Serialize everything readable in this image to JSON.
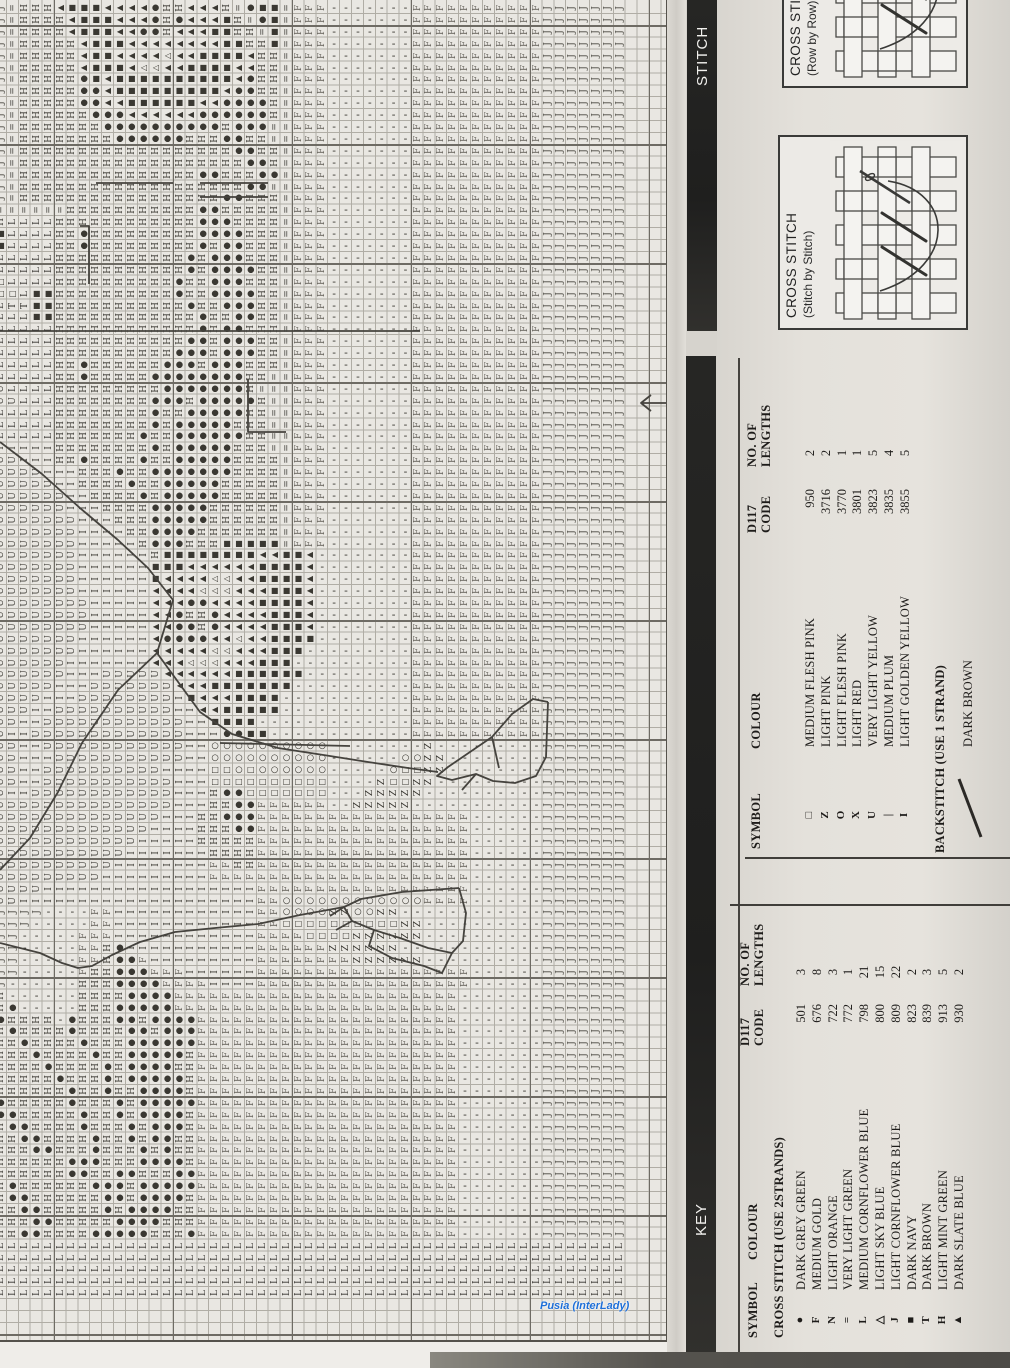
{
  "watermark": "Pusia (InterLady)",
  "bars": {
    "stitching_label": "STITCH",
    "key_label": "KEY"
  },
  "diagrams": {
    "row_by_row": {
      "title": "CROSS STITCH",
      "subtitle": "(Row by Row)"
    },
    "stitch_by_stitch": {
      "title": "CROSS STITCH",
      "subtitle": "(Stitch by Stitch)"
    }
  },
  "key_backstitch_table": {
    "headers": {
      "symbol": "SYMBOL",
      "colour": "COLOUR",
      "code_line1": "D117",
      "code_line2": "CODE",
      "lengths_line1": "NO. OF",
      "lengths_line2": "LENGTHS"
    },
    "rows": [
      {
        "symbol": "□",
        "colour": "MEDIUM FLESH PINK",
        "code": "950",
        "lengths": "2"
      },
      {
        "symbol": "Z",
        "colour": "LIGHT PINK",
        "code": "3716",
        "lengths": "2"
      },
      {
        "symbol": "O",
        "colour": "LIGHT FLESH PINK",
        "code": "3770",
        "lengths": "1"
      },
      {
        "symbol": "X",
        "colour": "LIGHT RED",
        "code": "3801",
        "lengths": "1"
      },
      {
        "symbol": "U",
        "colour": "VERY LIGHT YELLOW",
        "code": "3823",
        "lengths": "5"
      },
      {
        "symbol": "|",
        "colour": "MEDIUM PLUM",
        "code": "3835",
        "lengths": "4"
      },
      {
        "symbol": "I",
        "colour": "LIGHT GOLDEN YELLOW",
        "code": "3855",
        "lengths": "5"
      }
    ],
    "backstitch_title": "BACKSTITCH (USE 1 STRAND)",
    "backstitch_rows": [
      {
        "symbol": "diagonal-line",
        "colour": "DARK BROWN"
      }
    ]
  },
  "key_cross_stitch_table": {
    "headers": {
      "symbol": "SYMBOL",
      "colour": "COLOUR",
      "code_line1": "D117",
      "code_line2": "CODE",
      "lengths_line1": "NO. OF",
      "lengths_line2": "LENGTHS"
    },
    "section_title": "CROSS STITCH (USE 2STRANDS)",
    "rows": [
      {
        "symbol": "●",
        "colour": "DARK GREY GREEN",
        "code": "501",
        "lengths": "3"
      },
      {
        "symbol": "F",
        "colour": "MEDIUM GOLD",
        "code": "676",
        "lengths": "8"
      },
      {
        "symbol": "N",
        "colour": "LIGHT ORANGE",
        "code": "722",
        "lengths": "3"
      },
      {
        "symbol": "=",
        "colour": "VERY LIGHT GREEN",
        "code": "772",
        "lengths": "1"
      },
      {
        "symbol": "L",
        "colour": "MEDIUM CORNFLOWER BLUE",
        "code": "798",
        "lengths": "21"
      },
      {
        "symbol": "△",
        "colour": "LIGHT SKY BLUE",
        "code": "800",
        "lengths": "15"
      },
      {
        "symbol": "J",
        "colour": "LIGHT CORNFLOWER BLUE",
        "code": "809",
        "lengths": "22"
      },
      {
        "symbol": "■",
        "colour": "DARK NAVY",
        "code": "823",
        "lengths": "2"
      },
      {
        "symbol": "T",
        "colour": "DARK BROWN",
        "code": "839",
        "lengths": "3"
      },
      {
        "symbol": "H",
        "colour": "LIGHT MINT GREEN",
        "code": "913",
        "lengths": "5"
      },
      {
        "symbol": "▲",
        "colour": "DARK SLATE BLUE",
        "code": "930",
        "lengths": "2"
      }
    ]
  },
  "chart": {
    "columns": 56,
    "rows": 113,
    "cell_px": 11.9,
    "origin_x": -5,
    "origin_y": 2,
    "palette": {
      "I": {
        "g": "H",
        "r": 1,
        "c": "#37352f",
        "fs": 9
      },
      "H": {
        "g": "I",
        "r": 1,
        "c": "#37352f",
        "fs": 9
      },
      "C": {
        "g": "U",
        "r": 1,
        "c": "#45433d",
        "fs": 9
      },
      "F": {
        "g": "F",
        "r": 1,
        "c": "#615e57",
        "fs": 9
      },
      "J": {
        "g": "J",
        "r": 1,
        "c": "#4a4841",
        "fs": 9
      },
      "L": {
        "g": "L",
        "r": 1,
        "c": "#33312c",
        "fs": 9
      },
      "T": {
        "g": "T",
        "r": 1,
        "c": "#33312c",
        "fs": 9
      },
      "Z": {
        "g": "Z",
        "r": 1,
        "c": "#37352f",
        "fs": 9
      },
      "=": {
        "g": "=",
        "r": 1,
        "c": "#45433d",
        "fs": 9
      },
      "-": {
        "g": "-",
        "r": 0,
        "c": "#37352f",
        "fs": 11
      },
      "o": {
        "g": "●",
        "r": 0,
        "c": "#3a3832",
        "fs": 8.5
      },
      "O": {
        "g": "○",
        "r": 0,
        "c": "#37352f",
        "fs": 8.5
      },
      "s": {
        "g": "■",
        "r": 0,
        "c": "#3a3832",
        "fs": 8
      },
      "q": {
        "g": "□",
        "r": 0,
        "c": "#37352f",
        "fs": 8
      },
      "a": {
        "g": "▲",
        "r": 1,
        "c": "#3a3832",
        "fs": 8
      },
      "d": {
        "g": "△",
        "r": 1,
        "c": "#37352f",
        "fs": 8
      },
      "X": {
        "g": "X",
        "r": 0,
        "c": "#37352f",
        "fs": 9
      }
    },
    "grid_rows": [
      "J=IIIasssaaaaoIIaaaI=oss=FFF-------FFFFFFFFFFFJJJJJJJ...",
      "J=IIIIasssaaaoIoaaasI=os=FFF-------FFFFFFFFFFFJJJJJJJ...",
      "J=IIIIasssaaooIaaassII=s=FFF-------FFFFFFFFFFFJJJJJJJ...",
      "J=IIIIIasssaaaaaaaassIIs=FFF-------FFFFFFFFFFFJJJJJJJ...",
      "J=IIIIIassaaaadaassssaII=FFF-------FFFFFFFFFFFJJJJJJJ...",
      "J=IIIIIasssaddaassssaaII=FFF-------FFFFFFFFFFFJJJJJJJ...",
      "J=IIIIIosassssssssssaoII=FFF-------FFFFFFFFFFFJJJJJJJ...",
      "J=IIIIIooasssssssssaooII=FFF-------FFFFFFFFFFFJJJJJJJ...",
      "J=IIIIIooaassssssaaooooI=FFF-------FFFFFFFFFFFJJJJJJJ...",
      "J=IIIIIIoooaaaaaaooooooI=FFF-------FFFFFFFFFFFJJJJJJJ...",
      "J=IIIIIIIooooooooooIooo==FFF-------FFFFFFFFFFFJJJJJJJ...",
      "J=IIIIIIIIooooooIIIooII==FFF-------FFFFFFFFFFFJJJJJJJ...",
      "J=IIIIIIIIIIIIIIIIIIooII=FFF-------FFFFFFFFFFFJJJJJJJ...",
      "J=IIIIIIIIIIIIIIIIIIIooI=FFF-------FFFFFFFFFFFJJJJJJJ...",
      "J=IIIIIIIIIIIIIIIooIIIoo=FFF-------FFFFFFFFFFFJJJJJJJ...",
      "J=IIIIIIIIIIIIIIIIIIIoo==FFF-------FFFFFFFFFFFJJJJJJJ...",
      "J=IIIIIIIIIIIIIIIIIooIII=FFF-------FFFFFFFFFFFJJJJJJJ...",
      "======IIIIIIIIIIIooIIIII=FFF-------FFFFFFFFFFFJJJJJJJ...",
      "ILLLLIIIIIIIIIIIIoooIIII=FFF-------FFFFFFFFFFFJJJJJJJ...",
      "sLLLLIIoIIIIIIIIIooooIII=FFF-------FFFFFFFFFFFJJJJJJJ...",
      "sLLLLIIoIIIIIIIIIoIooIII=FFF-------FFFFFFFFFFFJJJJJJJ...",
      "LLLLLIIIIIIIIIIIoIoooIII=FFF-------FFFFFFFFFFFJJJJJJJ...",
      "LLLLLIIIIIIIIIIIoIooooII=FFF-------FFFFFFFFFFFJJJJJJJ...",
      "qLLLLIIIIIIIIIIoIIoooIII=FFF-------FFFFFFFFFFFJJJJJJJ...",
      "qqLssIIIIIIIIIIoIIooooII=FFF-------FFFFFFFFFFFJJJJJJJ...",
      "LTTssIIIIIIIIIIIoIIoooII=FFF-------FFFFFFFFFFFJJJJJJJ...",
      "LLLssIIIIIIIIIIIIoIIooII=FFF-------FFFFFFFFFFFJJJJJJJ...",
      "LLLLLIIIIIIIIIIIIoIooIII=FFF-------FFFFFFFFFFFJJJJJJJ...",
      "LLLLLIIIIIIIIIIIooIoooII=FFF-------FFFFFFFFFFFJJJJJJJ...",
      "LLLLLIIIIIIIIIIoooIoooII=FFF-------FFFFFFFFFFFJJJJJJJ...",
      "LLLLLIIoIIIIIIoooIoooIII=FFF-------FFFFFFFFFFFJJJJJJJ...",
      "LLLLLIIoIIIIIooooooooII==FFF-------FFFFFFFFFFFJJJJJJJ...",
      "CLLLLIIIIIIIIIoooooooI===FFF-------FFFFFFFFFFFJJJJJJJ...",
      "CCLLLIIIIIIIIoooIoooooI==FFF-------FFFFFFFFFFFJJJJJJJ...",
      "LLLLLIIIIIIIIoIIoooooII==FFF-------FFFFFFFFFFFJJJJJJJ...",
      "LLLLLIIIIIIIIoIoooooIII==FFF-------FFFFFFFFFFFJJJJJJJ...",
      "LLLLLIIIIIIIoIIooooooII==FFF-------FFFFFFFFFFFJJJJJJJ...",
      "HHHHHIIIIIIIIoIoooooIII==FFF-------FFFFFFFFFFFJJJJJJJ...",
      "CCHHHIIoIIIIoIIoooooIIII=FFF-------FFFFFFFFFFFJJJJJJJ...",
      "CCCCHHHIIIoIIoooooooIIII=FFF-------FFFFFFFFFFFJJJJJJJ...",
      "CCCCCHHIIIIoIIoooooIIIII=FFF-------FFFFFFFFFFFJJJJJJJ...",
      "CCCCCCHHIIIIoIoooooIIIII=FFF-------FFFFFFFFFFFJJJJJJJ...",
      "CCCCCCHHHIIIIoooooIIIIII=FFF-------FFFFFFFFFFFJJJJJJJ...",
      "CCCCCCCHHHIIIoooooIIIIII=FFF-------FFFFFFFFFFFJJJJJJJ...",
      "CCCCCCCHHHHIIooooIIIIIII=FFF-------FFFFFFFFFFFJJJJJJJ...",
      "CCCCCCCHHHHHIoooIIIsssss=FFF-------FFFFFFFFFFFJJJJJJJ...",
      "CCCCCCCHHHHHHIssssssssaassa--------FFFFFFFFFFFJJJJJJJ...",
      "CCCCCCCHHHHHHsssaaaaaassssa--------FFFFFFFFFFFJJJJJJJ...",
      "CCCCCCCHHHHHHsaaaaddaassssa--------FFFFFFFFFFFJJJJJJJ...",
      "CCCCCCCHHHHHHaaaadddaaasssa--------FFFFFFFFFFFJJJJJJJ...",
      "CCCCCCCCHHHHHaaaooaaaassssa--------FFFFFFFFFFFJJJJJJJ...",
      "CCCCCCCCHHHHHaaoIIoaaaasssa--------FFFFFFFFFFFJJJJJJJ...",
      "CCCCCCCCHHHHHaaooIoaaaasssa--------FFFFFFFFFFFJJJJJJJ...",
      "CCCCCCCHHHHHHaooooaadaassss--------FFFFFFFFFFFJJJJJJJ...",
      "CCCCCCCHHHHHHaaaaaddaaasss---------FFFFFFFFFFFJJJJJJJ...",
      "CCCCCCHHHHHHHaaadddaaasss----------FFFFFFFFFFFJJJJJJJ...",
      "CCCCCCHHHCCCCCaaaaaassssss---------FFFFFFFFFFFJJJJJJJ...",
      "CCCCCHHHCCCCCCCaaasssssss----------FFFFFFFFFFFJJJJJJJ...",
      "CCCCHHHCCCCCCCCHsaaassss-----------FFFFFFFFFFFJJJJJJJ...",
      "CCCHHCCCCCCCCCCHHaasssss-----------FFFFFFFFFFFJJJJJJJ...",
      "CCHHCCCCCCCCCCCCHHssss-------------FFFFFFFFFFFJJJJJJJ...",
      "CHHCCCCCCCCCCCCCHHHooss------------FFFFFFFFFFFJJJJJJJ...",
      "CCHHCCCCCCCCCCCCHHOOOOOOOOOO--------Z---------JJJJJJJ...",
      "CCHHHCCCCCCCCCCCHHOOOOOOOOOO------OOZZ--------JJJJJJJ...",
      "CCHHCCCCCCCCCCHHHHqqOqOOOOOO-----OqqZZ--------JJJJJJJ...",
      "CCHHCCCCCCCCCCCHHHqqqqqqqqqq----ZqqZZ---------JJJJJJJ...",
      "CHHCCCCCCCCCCCCHHHIooqqqqqqq---ZZZZZ----------JJJJJJJ...",
      "CCCCCCCCCCCCCCCHHHIIooFFFFFF--ZZZZZ-----------JJJJJJJ...",
      "CCCCCCCCCCCCCCHHHIIoooFFFFFFFFFFFFFFFFFF------JJJJJJJ...",
      "CCCCCCCCCCCCCHHHHIIIooFFFFFFFFFFFFFFFFFF------JJJJJJJ...",
      "CCCCCCCCCCCCHHHHHIIIIIFFFFFFFFFFFFFFFFFF------JJJJJJJ...",
      "CCCCCCCCCCCHHHHHHHIIIIFFFFFFFFFFFFFFFFFF------JJJJJJJ...",
      "CCCCCCCCCCHHHHHHHHFFIIFFFFFFFFFFFFFFFFFF------JJJJJJJ...",
      "CCCCCCCCCHHHHHHHHHFFFFFFFFFFFFFFFFFFFFFF------JJJJJJJ...",
      "CCCCHHHHHHHHHHHHHHHHHHFFFFFFFFFFFFFFFFFF------JJJJJJJ...",
      "CCHHHHHHHHHHHHHHHHHHHHFFOOOOOOOOOOOOFFFF------JJJJJJJ...",
      "JJJJ----FFHHHHHHHHHHHHFFOOOOZZOOZZ------------JJJJJJJ...",
      "JJJ-----FFHHHHHHHHHHHHFFqqqqqqqqqqZZ----------JJJJJJJ...",
      "JJ-----FFFHHHHHHHHHHHHFFFFqqqqZZZZZZ----------JJJJJJJ...",
      "JJ-----FFIoHHHHHHHHHHHFFFFFFZZZZZZ------------JJJJJJJ...",
      "JJ-----FFIooFHHHHHHHHHFFFFFFFFZZZZZZ----------JJJJJJJ...",
      "JJ-----FIIoooFFFHHHHHHFFFFFFFFFFFFFFFFFF------JJJJJJJ...",
      "J------IIIooooFFFFHHHHFFFFFFFFFFFFFFFFFF------JJJJJJJ...",
      "I------IIIIooooFFFFFFFFFFFFFFFFFFFFFFFF-------JJJJJJJ...",
      "Io-----IIIoooooFFFFFFFFFFFFFFFFFFFFFFFF-------JJJJJJJ...",
      "oIIII-oIIIooIooooFFFFFFFFFFFFFFFFFFFFFF-------JJJJJJJ...",
      "IoIIIIoIIIIooIoooFFFFFFFFFFFFFFFFFFFFFF-------JJJJJJJ...",
      "IIoIIIIoIIIooooooFFFFFFFFFFFFFFFFFFFFFF-------JJJJJJJ...",
      "IIIoIIIIoIIoooooIFFFFFFFFFFFFFFFFFFFFFF-------JJJJJJJ...",
      "IIIIoIIIIoIooooIIFFFFFFFFFFFFFFFFFFFFFF-------JJJJJJJ...",
      "IIIIIoIIIoIoooooIFFFFFFFFFFFFFFFFFFFFFF-------JJJJJJJ...",
      "IIIIIIoIIoIIooooIFFFFFFFFFFFFFFFFFFFFFF-------JJJJJJJ...",
      "oIIIIIoIIIoIoooooFFFFFFFFFFFFFFFFFFFFFF-------JJJJJJJ...",
      "ooIIIIIoIIoIooooIFFFFFFFFFFFFFFFFFFFFFF-------JJJJJJJ...",
      "IooIIIIoIIIoIoooIFFFFFFFFFFFFFFFFFFFFFF-------JJJJJJJ...",
      "IIooIIIIoIIoIooIIFFFFFFFFFFFFFFFFFFFFFF-------JJJJJJJ...",
      "IIIooIIIoIIIoIoIIFFFFFFFFFFFFFFFFFFFFFF-------JJJJJJJ...",
      "IIIIIIoooIIIooooIFFFFFFFFFFFFFFFFFFFFFF-------JJJJJJJ...",
      "IIIIIIooIIooIIIooFFFFFFFFFFFFFFFFFFFFFF-------JJJJJJJ...",
      "IoIIIIIIoooIoooooFFFFFFFFFFFFFFFFFFFFFF-------JJJJJJJ...",
      "IooIIIIIIooIooooIFFFFFFFFFFFFFFFFFFFFFF-------JJJJJJJ...",
      "IIooIIIIIoIooooIIFFFFFFFFFFFFFFFFFFFFFF-------JJJJJJJ...",
      "IIIooIIIIIooooIIIFFFFFFFFFFFFFFFFFFFFFF-------JJJJJJJ...",
      "IIooIIIIoooooIIIoFFFFFFFFFFFFFFFFFFFFFF-------JJJJJJJ...",
      "LLLLLLLLLLLLLLLLLLLLLLLLLLLLLLLLLLLLLLLLLLLLLLLLLLLLL...",
      "LLLLLLLLLLLLLLLLLLLLLLLLLLLLLLLLLLLLLLLLLLLLLLLLLLLLL...",
      "LLLLLLLLLLLLLLLLLLLLLLLLLLLLLLLLLLLLLLLLLLLLLLLLLLLLL...",
      "LLLLLLLLLLLLLLLLLLLLLLLLLLLLLLLLLLLLLLLLLLLLLLLLLLLLL...",
      "LLLLLLLLLLLLLLLLLLLLLLLLLLLLLLLLLLLLLLLLLLLLLLLLLLLLL...",
      "",
      "",
      "",
      ""
    ],
    "backstitch_paths": [
      "M96,183 L173,183 M200,183 L268,183 M200,197 L268,197",
      "M80,226 L89,226 L89,284",
      "M0,331 L420,331",
      "M248,379 L248,432 L286,432",
      "M0,442 L42,474 L80,508 L118,540 L148,568 L173,600",
      "M173,600 L157,653 L118,690 L82,743 L58,792 L30,838 L0,870",
      "M157,653 L200,712 L232,734 L278,748 L330,756 L368,762 L408,768 L438,772",
      "M220,743 L350,746",
      "M548,702 L533,699 L512,714 L492,737 L470,752 L448,767 L437,776 L452,780 L476,774 L493,781 L515,783 L536,776 L546,757 L548,702",
      "M476,774 L462,790 M492,737 L499,768",
      "M0,943 L40,953 L62,963 L78,968 L92,966 L112,955 L140,942 L175,932 L215,928 L258,924 L300,915 L344,907",
      "M459,888 L402,892 L361,899 L344,907 L352,921 L374,930 L400,938 L428,948 L452,953 L463,941 L466,913 L459,888",
      "M344,907 L330,916 M352,921 L336,930 M374,930 L369,946 L392,958 L424,966 L442,973 L452,953",
      "M666,403 L641,403 M651,395 L641,403 L651,411"
    ]
  }
}
